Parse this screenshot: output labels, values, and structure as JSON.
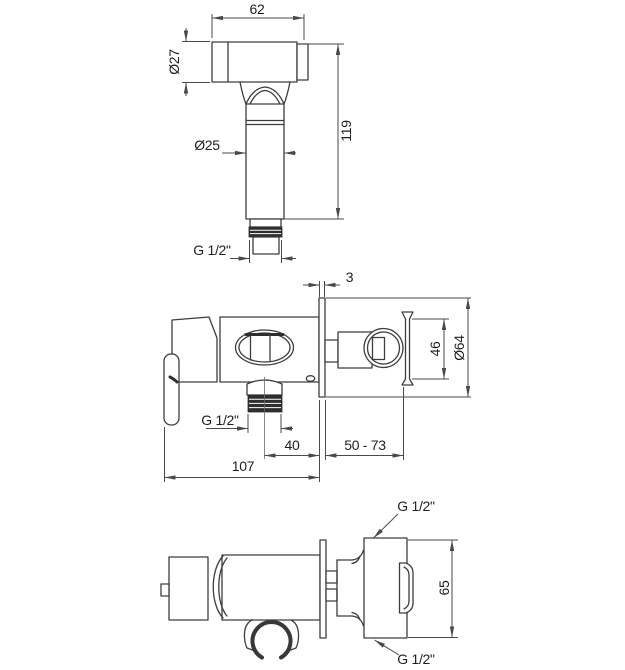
{
  "drawing": {
    "colors": {
      "line": "#3d3d3d",
      "dimension": "#4a4a4a",
      "text": "#1f1f1f",
      "thread_fill": "#2e2e2e",
      "background": "#ffffff"
    },
    "views": {
      "handset_front": {
        "description": "hand shower front view",
        "dimensions": {
          "head_width": "62",
          "head_diameter": "Ø27",
          "total_length": "119",
          "handle_diameter": "Ø25",
          "connector_thread": "G 1/2\""
        }
      },
      "mixer_side": {
        "description": "wall mixer side view",
        "dimensions": {
          "plate_thickness": "3",
          "holder_height": "46",
          "plate_diameter": "Ø64",
          "outlet_thread": "G 1/2\"",
          "outlet_to_wall": "40",
          "depth_range": "50 - 73",
          "total_width": "107"
        }
      },
      "mixer_top": {
        "description": "wall mixer top view",
        "dimensions": {
          "top_inlet_thread": "G 1/2\"",
          "body_height": "65",
          "bottom_inlet_thread": "G 1/2\""
        }
      }
    }
  }
}
